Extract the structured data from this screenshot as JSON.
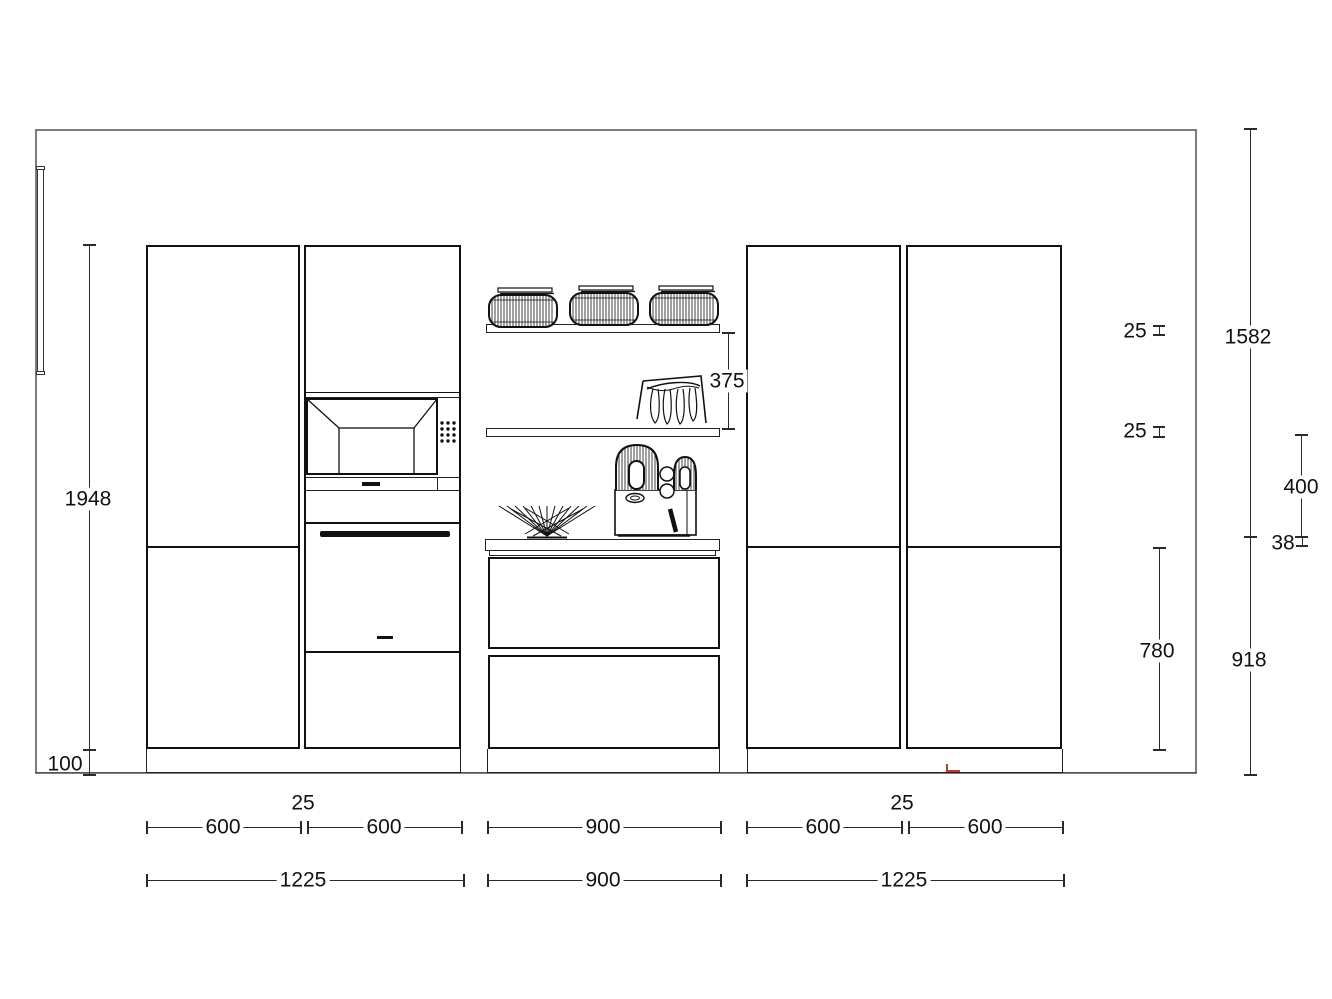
{
  "drawing": {
    "type": "kitchen-elevation-cad-drawing",
    "colors": {
      "line": "#111111",
      "wall_outline": "#7d7d7d",
      "background": "#ffffff",
      "marker_red": "#c23b2e"
    }
  },
  "dims_vertical": {
    "cabinet_height": "1948",
    "plinth_height": "100",
    "shelf_gap": "375",
    "shelf_top_thickness": "25",
    "shelf_bottom_thickness": "25",
    "wall_upper": "1582",
    "shelf_to_counter": "400",
    "counter_thickness": "38",
    "drawer_stack": "780",
    "base_height": "918"
  },
  "dims_row1": {
    "left_a": "600",
    "left_gap": "25",
    "left_b": "600",
    "middle": "900",
    "right_a": "600",
    "right_gap": "25",
    "right_b": "600"
  },
  "dims_row2": {
    "left": "1225",
    "middle": "900",
    "right": "1225"
  }
}
